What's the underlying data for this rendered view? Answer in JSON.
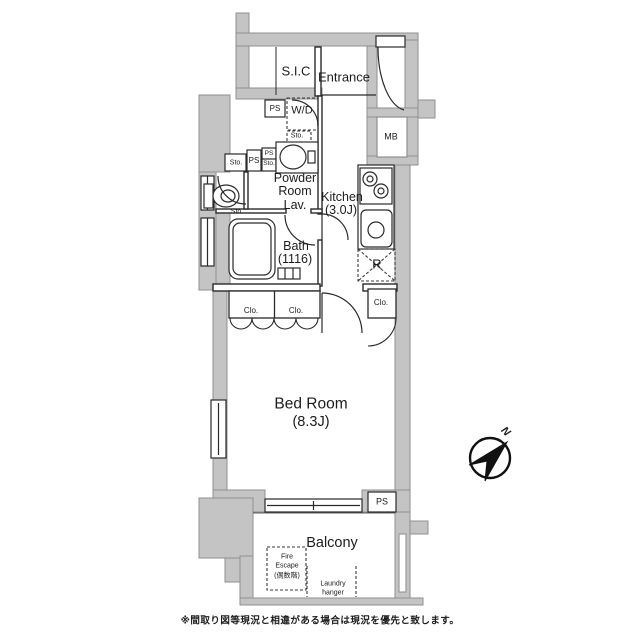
{
  "colors": {
    "background": "#ffffff",
    "wall_fill": "#c4c4c4",
    "wall_stroke": "#8f8f8f",
    "line": "#222222"
  },
  "plan": {
    "rooms": {
      "sic": "S.I.C",
      "entrance": "Entrance",
      "powder_line1": "Powder",
      "powder_line2": "Room",
      "powder_line3": "Lav.",
      "kitchen_line1": "Kitchen",
      "kitchen_line2": "(3.0J)",
      "bath_line1": "Bath",
      "bath_line2": "(1116)",
      "bedroom_line1": "Bed Room",
      "bedroom_line2": "(8.3J)",
      "balcony": "Balcony"
    },
    "labels": {
      "ps_top": "PS",
      "wd": "W/D",
      "sto_under_wd": "Sto.",
      "mb": "MB",
      "sto_row": "Sto.",
      "ps_row": "PS",
      "ps_sto_line1": "PS",
      "ps_sto_line2": "Sto.",
      "sto_toilet": "Sto.",
      "fridge": "R",
      "clo_left_a": "Clo.",
      "clo_left_b": "Clo.",
      "clo_right": "Clo.",
      "ps_bottom": "PS",
      "fire_escape_line1": "Fire",
      "fire_escape_line2": "Escape",
      "fire_escape_line3": "(偶数階)",
      "laundry_line1": "Laundry",
      "laundry_line2": "hanger",
      "compass_north": "N"
    },
    "footer_note": "※間取り図等現況と相違がある場合は現況を優先と致します。"
  }
}
